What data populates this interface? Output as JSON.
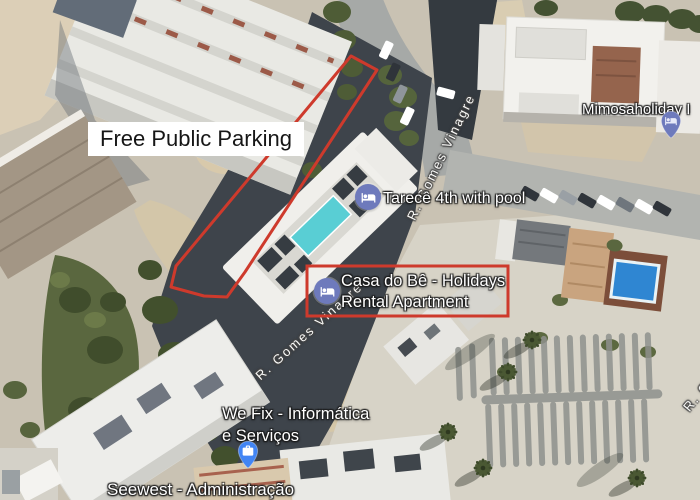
{
  "annotations": {
    "free_parking": {
      "label": "Free Public Parking"
    }
  },
  "pois": {
    "mimosa": {
      "label": "Mimosaholiday I"
    },
    "tarece": {
      "label": "Tarecê 4th with pool"
    },
    "casa": {
      "line1": "Casa do Bê - Holidays",
      "line2": "Rental Apartment"
    },
    "wefix": {
      "line1": "We Fix - Informática",
      "line2": "e Serviços"
    },
    "seewest": {
      "label": "Seewest - Administração"
    }
  },
  "streets": {
    "upper": {
      "label": "R. Gomes Vinagre"
    },
    "lower": {
      "label": "R. Gomes Vinagre"
    },
    "right_partial": {
      "label": "R. G"
    }
  },
  "icons": {
    "hotel": "hotel-bed-icon",
    "lodging_pin": "lodging-pin-icon",
    "business_pin": "briefcase-pin-icon"
  },
  "colors": {
    "annotation_red": "#ce3a2c",
    "lodging_icon_blue": "#6e7abc",
    "business_pin_blue": "#4285f4",
    "pool_teal": "#59ced4",
    "pool_blue": "#2f86d2"
  }
}
